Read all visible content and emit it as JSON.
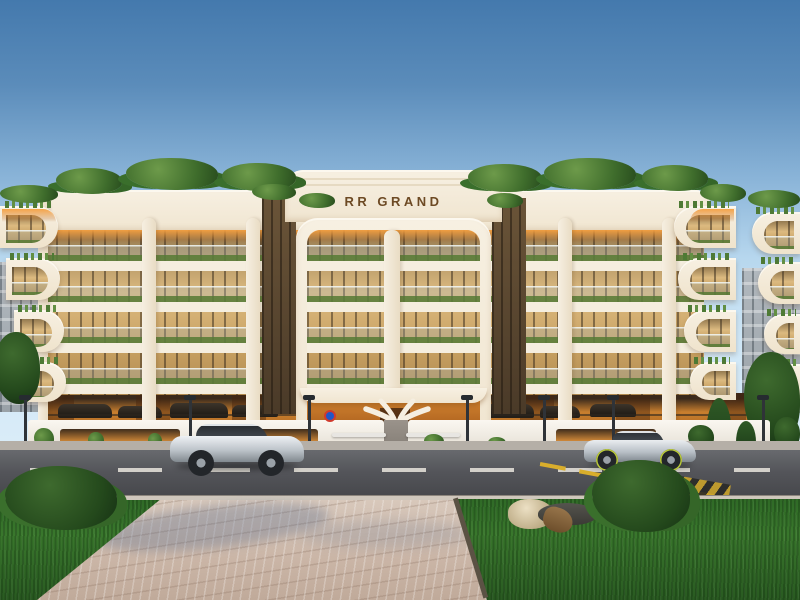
{
  "scene": {
    "type": "architectural-exterior-render",
    "building": {
      "sign_text": "RR GRAND",
      "sign_color": "#6d4a24",
      "balcony_floors_visible": 4,
      "style": "curved cream facade with glass balconies, balcony planters and rooftop greenery",
      "ground_level": "open parking with warm orange lighting and white branching sculptural columns at entrance"
    },
    "colors": {
      "sky_top": "#4479ad",
      "sky_horizon": "#dcedf8",
      "facade_cream": "#f5eedf",
      "glass_warm": "#dcba80",
      "soffit_orange": "#e9973f",
      "parking_glow": "#c0732a",
      "greenery": "#3f6d2c",
      "road_asphalt": "#505156",
      "lane_marking_white": "#dedbd3",
      "hazard_yellow": "#d9ae2c",
      "paver_sidewalk": "#cfbcad",
      "lawn_green": "#2f6a26",
      "car_silver": "#c9ced4"
    },
    "vehicles": [
      {
        "name": "silver-suv",
        "position": "left lane, facing left"
      },
      {
        "name": "silver-sports-car",
        "position": "right lane, facing left"
      }
    ],
    "environment": [
      "gradient blue sky",
      "background city buildings at both edges",
      "street lamps along boundary wall",
      "white boundary wall with lit hedge niches",
      "asphalt road with dashed white center line",
      "yellow diagonal hazard marking",
      "paver sidewalk foreground",
      "green lawn with rocks, driftwood and trimmed bushes"
    ]
  }
}
